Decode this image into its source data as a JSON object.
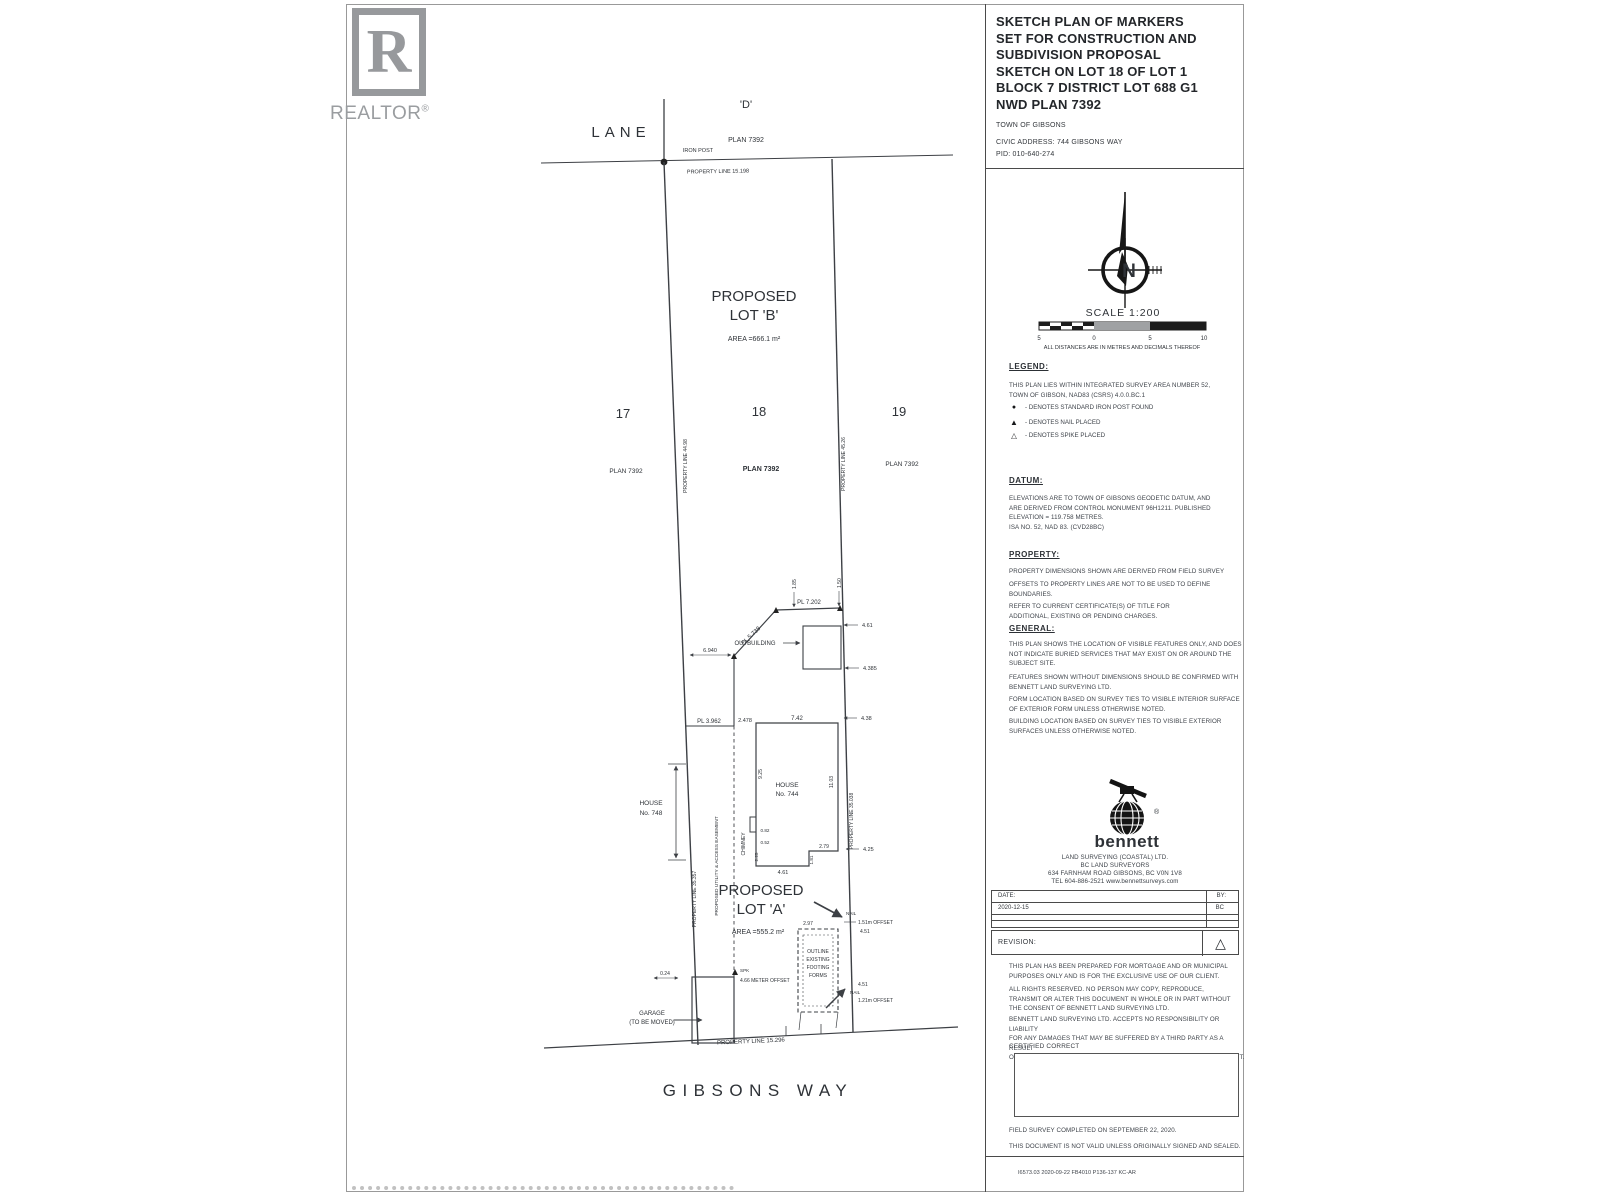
{
  "watermark": {
    "letter": "R",
    "label": "REALTOR",
    "reg": "®"
  },
  "title_block": {
    "title": "SKETCH PLAN OF MARKERS\nSET FOR CONSTRUCTION AND\nSUBDIVISION PROPOSAL\nSKETCH ON LOT 18 OF LOT 1\nBLOCK 7 DISTRICT LOT 688 G1\nNWD PLAN 7392",
    "municipality": "TOWN OF GIBSONS",
    "civic_address": "CIVIC ADDRESS: 744 GIBSONS WAY",
    "pid": "PID:   010-640-274"
  },
  "compass": {
    "n": "N",
    "scale_label": "SCALE  1:200",
    "ticks": {
      "t1": "5",
      "t2": "0",
      "t3": "5",
      "t4": "10"
    },
    "units_note": "ALL DISTANCES ARE IN METRES AND DECIMALS THEREOF"
  },
  "legend": {
    "heading": "LEGEND:",
    "intro": "THIS PLAN LIES WITHIN INTEGRATED SURVEY AREA NUMBER 52,\nTOWN OF GIBSON, NAD83 (CSRS) 4.0.0.BC.1",
    "items": [
      {
        "symbol": "●",
        "text": "- DENOTES STANDARD IRON POST FOUND"
      },
      {
        "symbol": "▲",
        "text": "- DENOTES NAIL PLACED"
      },
      {
        "symbol": "△",
        "text": "- DENOTES SPIKE PLACED"
      }
    ]
  },
  "datum": {
    "heading": "DATUM:",
    "body": "ELEVATIONS ARE TO TOWN OF GIBSONS GEODETIC DATUM, AND\nARE DERIVED FROM CONTROL MONUMENT 96H1211.  PUBLISHED\nELEVATION = 119.758 METRES.\nISA NO. 52, NAD 83. (CVD28BC)"
  },
  "property": {
    "heading": "PROPERTY:",
    "p1": "PROPERTY DIMENSIONS SHOWN ARE DERIVED FROM  FIELD SURVEY",
    "p2": "OFFSETS TO PROPERTY LINES ARE NOT TO  BE USED TO DEFINE\nBOUNDARIES.",
    "p3": "REFER  TO CURRENT CERTIFICATE(S) OF TITLE FOR\nADDITIONAL, EXISTING OR PENDING CHARGES."
  },
  "general": {
    "heading": "GENERAL:",
    "p1": "THIS PLAN SHOWS THE LOCATION OF VISIBLE FEATURES ONLY, AND DOES\nNOT INDICATE BURIED SERVICES THAT MAY EXIST ON OR AROUND THE\nSUBJECT SITE.",
    "p2": "FEATURES SHOWN  WITHOUT DIMENSIONS SHOULD BE CONFIRMED WITH\nBENNETT LAND SURVEYING LTD.",
    "p3": "FORM LOCATION BASED ON SURVEY TIES TO VISIBLE INTERIOR  SURFACE\nOF EXTERIOR FORM UNLESS OTHERWISE NOTED.",
    "p4": "BUILDING LOCATION BASED ON SURVEY TIES TO VISIBLE EXTERIOR\nSURFACES UNLESS OTHERWISE NOTED."
  },
  "surveyor": {
    "name": "bennett",
    "reg": "®",
    "address": "LAND SURVEYING (COASTAL) LTD.\nBC LAND SURVEYORS\n634 FARNHAM ROAD      GIBSONS, BC      V0N 1V8\nTEL  604-886-2521       www.bennettsurveys.com"
  },
  "approval": {
    "date_label": "DATE:",
    "by_label": "BY:",
    "date_value": "2020-12-15",
    "by_value": "BC",
    "revision_label": "REVISION:",
    "revision_symbol": "△"
  },
  "notes": {
    "p1": "THIS PLAN HAS BEEN PREPARED FOR MORTGAGE AND OR MUNICIPAL\nPURPOSES ONLY AND IS FOR THE EXCLUSIVE USE  OF OUR CLIENT.",
    "p2": "ALL RIGHTS RESERVED.  NO PERSON MAY COPY, REPRODUCE,\nTRANSMIT OR ALTER THIS DOCUMENT IN WHOLE OR IN PART WITHOUT\nTHE CONSENT OF BENNETT LAND SURVEYING LTD.",
    "p3": "BENNETT LAND SURVEYING LTD. ACCEPTS NO RESPONSIBILITY OR LIABILITY\nFOR ANY DAMAGES THAT MAY BE SUFFERED BY A THIRD PARTY AS A RESULT\nOF ANY DECISIONS MADE, OR ACTIONS TAKEN BASED ON THIS DOCUMENT.",
    "certified": "CERTIFIED CORRECT",
    "field_survey": "FIELD SURVEY COMPLETED ON SEPTEMBER 22, 2020.",
    "validity": "THIS DOCUMENT IS NOT VALID UNLESS ORIGINALLY SIGNED AND SEALED.",
    "file_ref": "I6573.03 2020-09-22 FB4010 P136-137 KC-AR"
  },
  "plan": {
    "lane": "LANE",
    "block_d": "'D'",
    "block_d_plan": "PLAN 7392",
    "iron_post": "IRON POST",
    "pl_top": "PROPERTY LINE  15.198",
    "lot_b": {
      "l1": "PROPOSED",
      "l2": "LOT 'B'",
      "area": "AREA =666.1 m²"
    },
    "lot_a": {
      "l1": "PROPOSED",
      "l2": "LOT 'A'",
      "area": "AREA =555.2 m²"
    },
    "lot17": {
      "num": "17",
      "plan": "PLAN 7392"
    },
    "lot18": {
      "num": "18",
      "plan": "PLAN  7392"
    },
    "lot19": {
      "num": "19",
      "plan": "PLAN 7392"
    },
    "pl_left_upper": "PROPERTY LINE 44.98",
    "pl_right_upper": "PROPERTY LINE 45.26",
    "pl_left_lower": "PROPERTY LINE 35.357",
    "pl_right_lower": "PROPERTY LINE 35.038",
    "easement": "PROPOSED UTILITY & ACCESS EASEMENT",
    "pl_diag": "PL 5.738",
    "pl_step": "PL 7.202",
    "pl_west": "PL 3.962",
    "outbuilding": "OUTBUILDING",
    "house": {
      "l1": "HOUSE",
      "l2": "No. 744"
    },
    "neighbor": {
      "l1": "HOUSE",
      "l2": "No. 748"
    },
    "chimney": "CHIMNEY",
    "footing": {
      "l1": "OUTLINE",
      "l2": "EXISTING",
      "l3": "FOOTING",
      "l4": "FORMS"
    },
    "garage": {
      "l1": "GARAGE",
      "l2": "(TO BE MOVED)"
    },
    "nail1": "NAIL",
    "nail2": "NAIL",
    "spk": "SPK",
    "offset1": "1.51m OFFSET",
    "offset2": "1.21m OFFSET",
    "offset3": "4.66 METER OFFSET",
    "pl_bottom": "PROPERTY LINE  15.296",
    "street": "GIBSONS WAY",
    "dims": {
      "d6940": "6.940",
      "d461": "4.61",
      "d4385": "4.385",
      "d185": "1.85",
      "d150": "1.50",
      "d438": "4.38",
      "d425": "4.25",
      "d2478": "2.478",
      "d742": "7.42",
      "d925": "9.25",
      "d1103": "11.03",
      "d082": "0.82",
      "d052": "0.52",
      "d225": "2.25",
      "d279": "2.79",
      "d461b": "4.61",
      "d181": "1.81",
      "d297": "2.97",
      "d451": "4.51",
      "d451b": "4.51",
      "d024": "0.24"
    }
  }
}
